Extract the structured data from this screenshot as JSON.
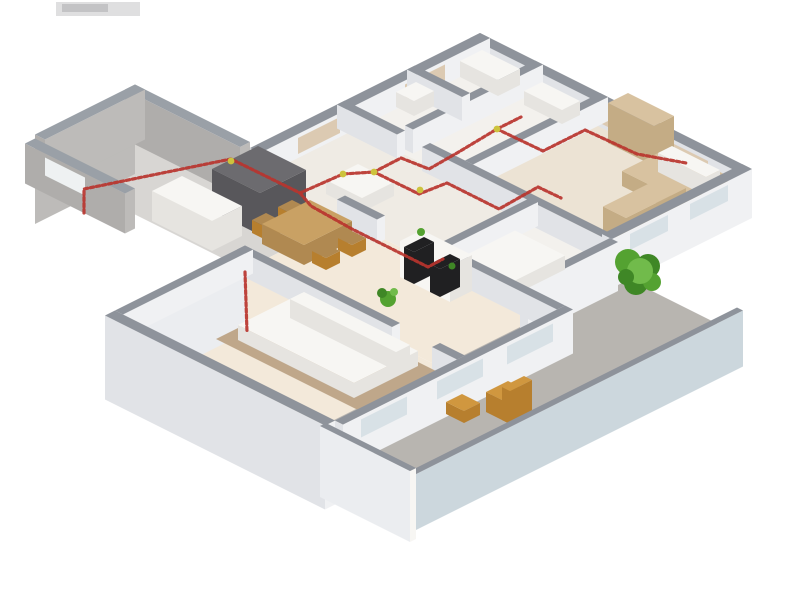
{
  "description": "3D isometric cutaway floor plan of an apartment: gray-topped walls, cream room floors, red electrical wiring routes running along wall tops with yellow junction nodes, furnished rooms (beds, dining set, dark kitchen unit, white media wall with black TV panels), a gray entry porch at the upper left, a concrete terrace at the lower right with wooden chairs, and green shrubs",
  "palette": {
    "bg": "#ffffff",
    "wallTop": "#8e939b",
    "wallFaceLight": "#f0f1f3",
    "wallFaceShade": "#e1e3e7",
    "porchTop": "#9aa0a7",
    "porchFace": "#bdbbb9",
    "porchFaceShade": "#afadab",
    "porchFloor": "#d8d6d3",
    "floorWhite": "#f3f1ed",
    "floorCream": "#f3e9da",
    "floorBeige": "#ece3d4",
    "floorHall": "#efebe4",
    "concrete": "#b8b5b0",
    "slabFace": "#ebedf0",
    "glass": "#ccd7dd",
    "windowTint": "#d8e1e6",
    "windowBeige": "#dccab2",
    "wire": "#b9342e",
    "node": "#cdc33d",
    "wood": "#c9a164",
    "woodDark": "#b08951",
    "orange": "#d0973f",
    "orangeDark": "#b77f2e",
    "darkUnit": "#58575b",
    "darkUnitTop": "#6c6b6f",
    "black": "#202022",
    "white": "#f7f6f3",
    "whiteShade": "#e6e4e0",
    "tan": "#d8c2a0",
    "tanShade": "#c4ac85",
    "rug": "#bfa78a",
    "greenDark": "#3f8726",
    "green": "#54a231",
    "greenLight": "#71bb4b",
    "grayFragment": "#c4c4c6",
    "fragmentDark": "#a8a8aa"
  },
  "wiring": {
    "paths": [
      [
        [
          84,
          213
        ],
        [
          84,
          189
        ],
        [
          231,
          159
        ],
        [
          300,
          193
        ],
        [
          343,
          174
        ],
        [
          374,
          172
        ]
      ],
      [
        [
          374,
          172
        ],
        [
          401,
          158
        ],
        [
          429,
          169
        ],
        [
          457,
          153
        ],
        [
          497,
          129
        ],
        [
          521,
          117
        ]
      ],
      [
        [
          497,
          129
        ],
        [
          543,
          151
        ],
        [
          585,
          130
        ],
        [
          637,
          154
        ],
        [
          686,
          163
        ]
      ],
      [
        [
          374,
          172
        ],
        [
          419,
          194
        ],
        [
          447,
          183
        ],
        [
          499,
          209
        ],
        [
          538,
          187
        ],
        [
          561,
          198
        ]
      ],
      [
        [
          300,
          193
        ],
        [
          311,
          206
        ],
        [
          352,
          229
        ],
        [
          404,
          255
        ],
        [
          428,
          267
        ],
        [
          443,
          259
        ]
      ],
      [
        [
          245,
          272
        ],
        [
          247,
          332
        ]
      ]
    ],
    "nodes": [
      [
        231,
        161
      ],
      [
        343,
        174
      ],
      [
        374,
        172
      ],
      [
        420,
        190
      ],
      [
        497,
        129
      ]
    ]
  },
  "objects": [
    "entry-porch",
    "bathroom",
    "hallway",
    "bedroom-right",
    "bedroom-small",
    "living-dining-room",
    "master-bedroom",
    "balcony-terrace",
    "kitchen-unit",
    "dining-table",
    "media-wall",
    "tv-panel",
    "wardrobe",
    "bed",
    "rug",
    "balcony-chair",
    "shrub",
    "wiring-path",
    "wiring-node"
  ]
}
